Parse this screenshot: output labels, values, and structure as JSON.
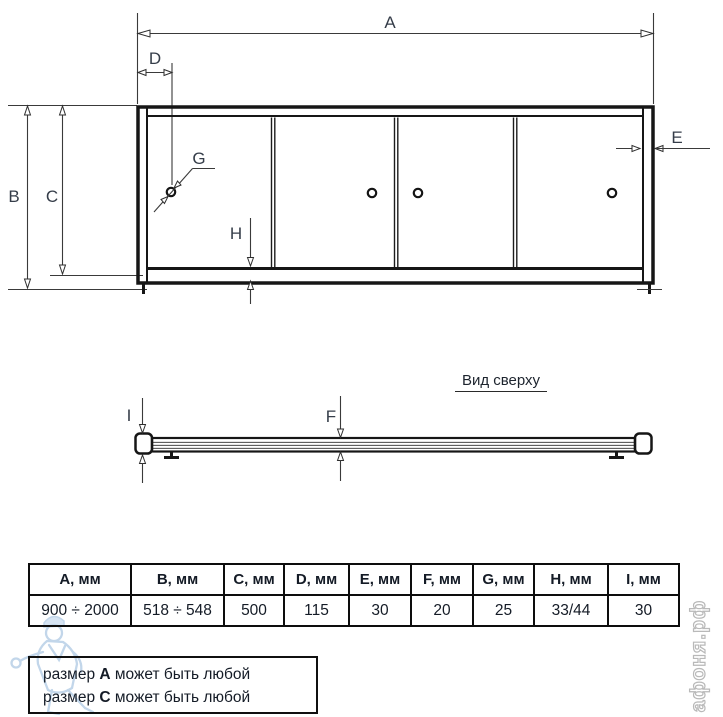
{
  "front_view": {
    "dim_labels": {
      "A": "A",
      "B": "B",
      "C": "C",
      "D": "D",
      "E": "E",
      "G": "G",
      "H": "H"
    }
  },
  "top_view": {
    "title": "Вид сверху",
    "dim_labels": {
      "I": "I",
      "F": "F"
    }
  },
  "table": {
    "headers": [
      "A, мм",
      "B, мм",
      "C, мм",
      "D, мм",
      "E, мм",
      "F, мм",
      "G, мм",
      "H, мм",
      "I, мм"
    ],
    "values": [
      "900 ÷ 2000",
      "518 ÷ 548",
      "500",
      "115",
      "30",
      "20",
      "25",
      "33/44",
      "30"
    ]
  },
  "dimensions_mm": {
    "A": "900 ÷ 2000",
    "B": "518 ÷ 548",
    "C": "500",
    "D": "115",
    "E": "30",
    "F": "20",
    "G": "25",
    "H": "33/44",
    "I": "30"
  },
  "notes": {
    "line1_prefix": "размер ",
    "line1_dim": "A",
    "line1_suffix": " может быть любой",
    "line2_prefix": "размер ",
    "line2_dim": "C",
    "line2_suffix": " может быть любой"
  },
  "watermarks": {
    "site": "афоня.рф",
    "mascot": "plumber-mascot"
  },
  "colors": {
    "line": "#161616",
    "dim_line": "#3a3a3a",
    "label_text": "#353d49",
    "table_text": "#141b26",
    "mascot_blue": "#86aed6",
    "site_gray": "#b9b9b9"
  }
}
